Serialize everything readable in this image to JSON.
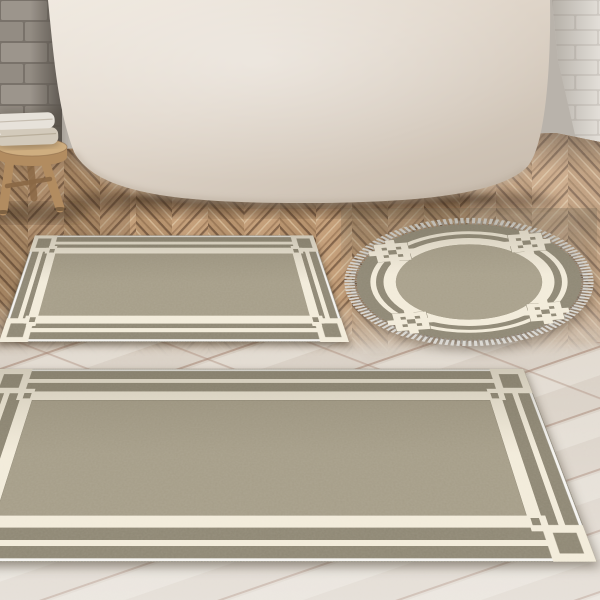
{
  "meta": {
    "scene": "bathroom product photo: three-piece bath mat set on parquet floor in front of freestanding bathtub",
    "visible_text": ""
  },
  "colors": {
    "wall_brick_gray": "#9c958c",
    "wall_brick_gray2": "#938c83",
    "wall_mortar_gray": "#79726a",
    "wall_corner_shadow": "#5e5851",
    "wall_brick_white": "#e3dfd9",
    "wall_white_mortar": "#cfcac3",
    "tub_light": "#efe8de",
    "tub_mid": "#e0d6ca",
    "tub_dark": "#c8bcae",
    "floor_base": "#a87f58",
    "plank_mid": "#b5906a",
    "plank_alt": "#c39d77",
    "plank_light": "#d9bf9c",
    "plank_dark": "#7c593c",
    "seam_dark": "#5c402b",
    "lightfloor_base": "#d8cfc4",
    "lightfloor_light": "#e9e3da",
    "lightfloor_seam": "#a07e6c",
    "rug_field": "#a59d88",
    "rug_field_round": "#a8a08b",
    "rug_margin": "#8e8774",
    "rug_cream": "#f2ebda",
    "rug_binding": "#f5f4f1",
    "fringe": "#d8d6d1",
    "fringe_shadow": "#9b9791",
    "stool_wood_light": "#cfae80",
    "stool_wood": "#b28c60",
    "stool_wood_dark": "#8a6845",
    "towel_white": "#e7e2da",
    "towel_beige": "#d3cabb"
  },
  "objects": {
    "wall_left": "gray brick wall",
    "wall_right": "white painted brick wall",
    "bathtub": "freestanding white bathtub",
    "stool": "rustic wooden stool",
    "towels": [
      "folded white towel",
      "folded beige towel"
    ],
    "floor_upper": "warm oak chevron parquet",
    "floor_lower": "whitewashed diagonal plank floor",
    "rugs": [
      {
        "name": "rectangular bath mat small",
        "shape": "rectangle",
        "pattern": "greek-key double border with interlocked corner squares",
        "field": "taupe",
        "border": "cream"
      },
      {
        "name": "round bath mat",
        "shape": "circle",
        "pattern": "double ring with key squares at diagonals",
        "fringe": true,
        "field": "taupe",
        "border": "cream"
      },
      {
        "name": "rectangular bath mat large",
        "shape": "rectangle",
        "pattern": "greek-key double border with interlocked corner squares",
        "field": "taupe",
        "border": "cream"
      }
    ]
  }
}
